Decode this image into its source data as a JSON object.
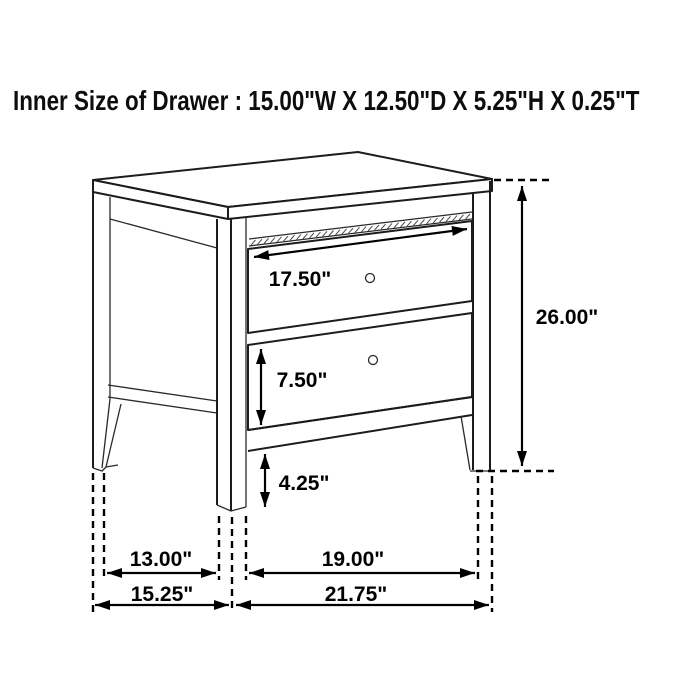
{
  "title": "Inner Size of Drawer : 15.00\"W X 12.50\"D X 5.25\"H X 0.25\"T",
  "diagram": {
    "type": "furniture-dimension-drawing",
    "item": "two-drawer nightstand",
    "dimensions": {
      "drawer_width": "17.50\"",
      "overall_height": "26.00\"",
      "bottom_drawer_height": "7.50\"",
      "leg_height": "4.25\"",
      "leg_span_depth": "13.00\"",
      "overall_depth": "15.25\"",
      "leg_span_width": "19.00\"",
      "overall_width": "21.75\""
    }
  },
  "colors": {
    "line": "#1c1c1c",
    "dimension": "#000000",
    "background": "#ffffff"
  }
}
